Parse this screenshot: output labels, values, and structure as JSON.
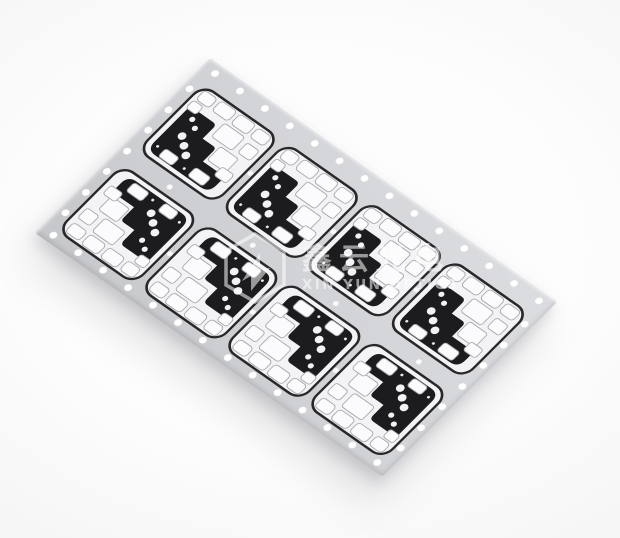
{
  "photo": {
    "alt": "Tilted light-gray aluminum panel holding eight black-and-white LED PCB modules, perforated with rows of round holes along every edge",
    "background_color": "#fcfcfc"
  },
  "panel": {
    "surface_color_light": "#dcdde0",
    "surface_color_dark": "#c6c7ca",
    "grid": {
      "rows": 2,
      "cols": 4,
      "module_count": 8
    },
    "holes": {
      "long_edge_count": 14,
      "short_edge_count": 7,
      "interior_count": 10,
      "color": "#ffffff"
    },
    "module": {
      "mask_black": "#1c1c1e",
      "substrate": "#f3f3f5",
      "pad_fill": "#fbfbfd",
      "pad_outline": "#a9abb1",
      "outline": "#28282b",
      "dot_fill": "#f2f2f4",
      "big_dots_per_module": 3,
      "small_dots_per_module": 2
    }
  },
  "watermark": {
    "logo_icon": "hexagon-logo",
    "cn_text": "鑫云光电",
    "en_text": "XIN YUN OPTICS",
    "color": "#ffffff",
    "opacity": 0.55
  }
}
